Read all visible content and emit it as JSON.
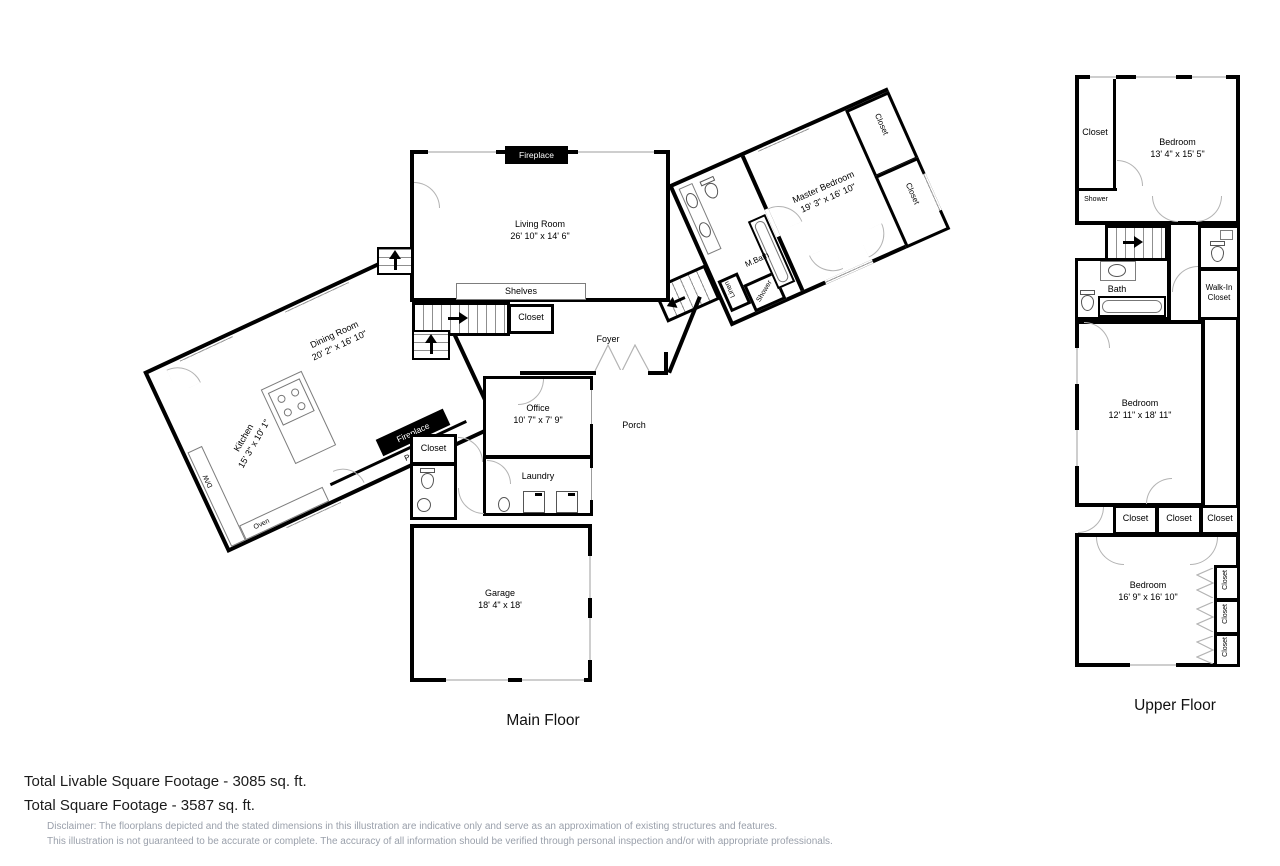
{
  "labels": {
    "closet": "Closet",
    "fireplace": "Fireplace",
    "shelves": "Shelves",
    "foyer": "Foyer",
    "porch": "Porch",
    "laundry": "Laundry",
    "pantry": "Pantry",
    "dw": "D/W",
    "oven": "Oven",
    "linen": "Linen",
    "shower": "Shower",
    "mbath": "M.Bath",
    "bath": "Bath",
    "walk_in": "Walk-In Closet"
  },
  "main_floor": {
    "title": "Main Floor",
    "living": {
      "name": "Living Room",
      "dims": "26' 10\" x 14' 6\""
    },
    "dining": {
      "name": "Dining Room",
      "dims": "20' 2\" x 16' 10\""
    },
    "kitchen": {
      "name": "Kitchen",
      "dims": "15' 3\" x 10' 1\""
    },
    "master": {
      "name": "Master Bedroom",
      "dims": "19' 3\" x 16' 10\""
    },
    "office": {
      "name": "Office",
      "dims": "10' 7\" x 7' 9\""
    },
    "garage": {
      "name": "Garage",
      "dims": "18' 4\" x 18'"
    }
  },
  "upper_floor": {
    "title": "Upper Floor",
    "bedroom1": {
      "name": "Bedroom",
      "dims": "13' 4\" x 15' 5\""
    },
    "bedroom2": {
      "name": "Bedroom",
      "dims": "12' 11\" x 18' 11\""
    },
    "bedroom3": {
      "name": "Bedroom",
      "dims": "16' 9\" x 16' 10\""
    }
  },
  "footer": {
    "total_livable": "Total Livable Square Footage - 3085 sq. ft.",
    "total": "Total Square Footage - 3587 sq. ft.",
    "disclaimer1": "Disclaimer: The floorplans depicted and the stated dimensions in this illustration are indicative only and serve as an approximation of existing structures and features.",
    "disclaimer2": "This illustration is not guaranteed to be accurate or complete. The accuracy of all information should be verified through personal inspection and/or with appropriate professionals."
  },
  "colors": {
    "wall": "#000000",
    "door": "#b3b3b3",
    "disclaimer": "#9aa0ab"
  }
}
